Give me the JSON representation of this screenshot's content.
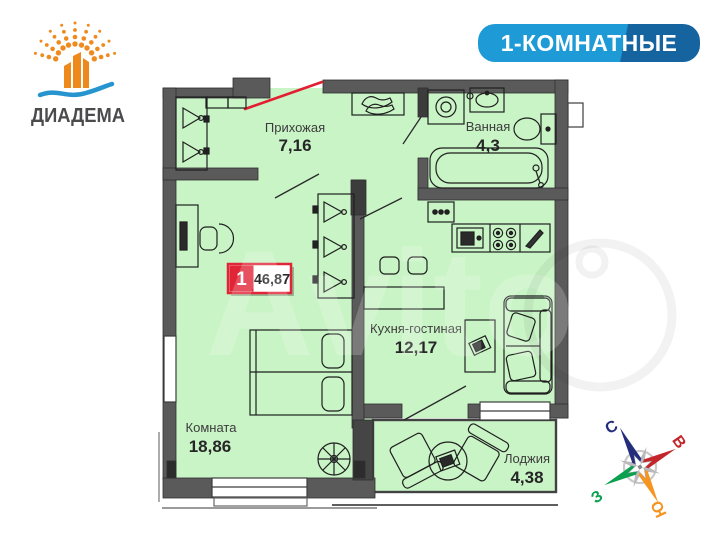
{
  "logo": {
    "name": "ДИАДЕМА"
  },
  "header_badge": {
    "label": "1-КОМНАТНЫЕ"
  },
  "plan": {
    "total": {
      "rooms_count": "1",
      "total_area": "46,87"
    },
    "rooms": {
      "hallway": {
        "name": "Прихожая",
        "area": "7,16"
      },
      "bathroom": {
        "name": "Ванная",
        "area": "4,3"
      },
      "kitchen_living": {
        "name": "Кухня-гостиная",
        "area": "12,17"
      },
      "bedroom": {
        "name": "Комната",
        "area": "18,86"
      },
      "loggia": {
        "name": "Лоджия",
        "area": "4,38"
      }
    }
  },
  "compass": {
    "north": "С",
    "east": "В",
    "south": "Ю",
    "west": "З"
  },
  "watermark": {
    "text": "Avito"
  },
  "colors": {
    "floor_green": "#c9f4c6",
    "wall_gray": "#5a5a5a",
    "accent_red": "#e31e30",
    "badge_blue": "#1e9ad6",
    "badge_blue_dark": "#15639f",
    "logo_orange": "#ef8a1e",
    "logo_wave_blue": "#2694ce",
    "logo_text_gray": "#4b4b4d",
    "compass_north_blue": "#232d7c",
    "compass_east_red": "#c4252b",
    "compass_south_orange": "#f5941f",
    "compass_west_green": "#0ba04f"
  }
}
